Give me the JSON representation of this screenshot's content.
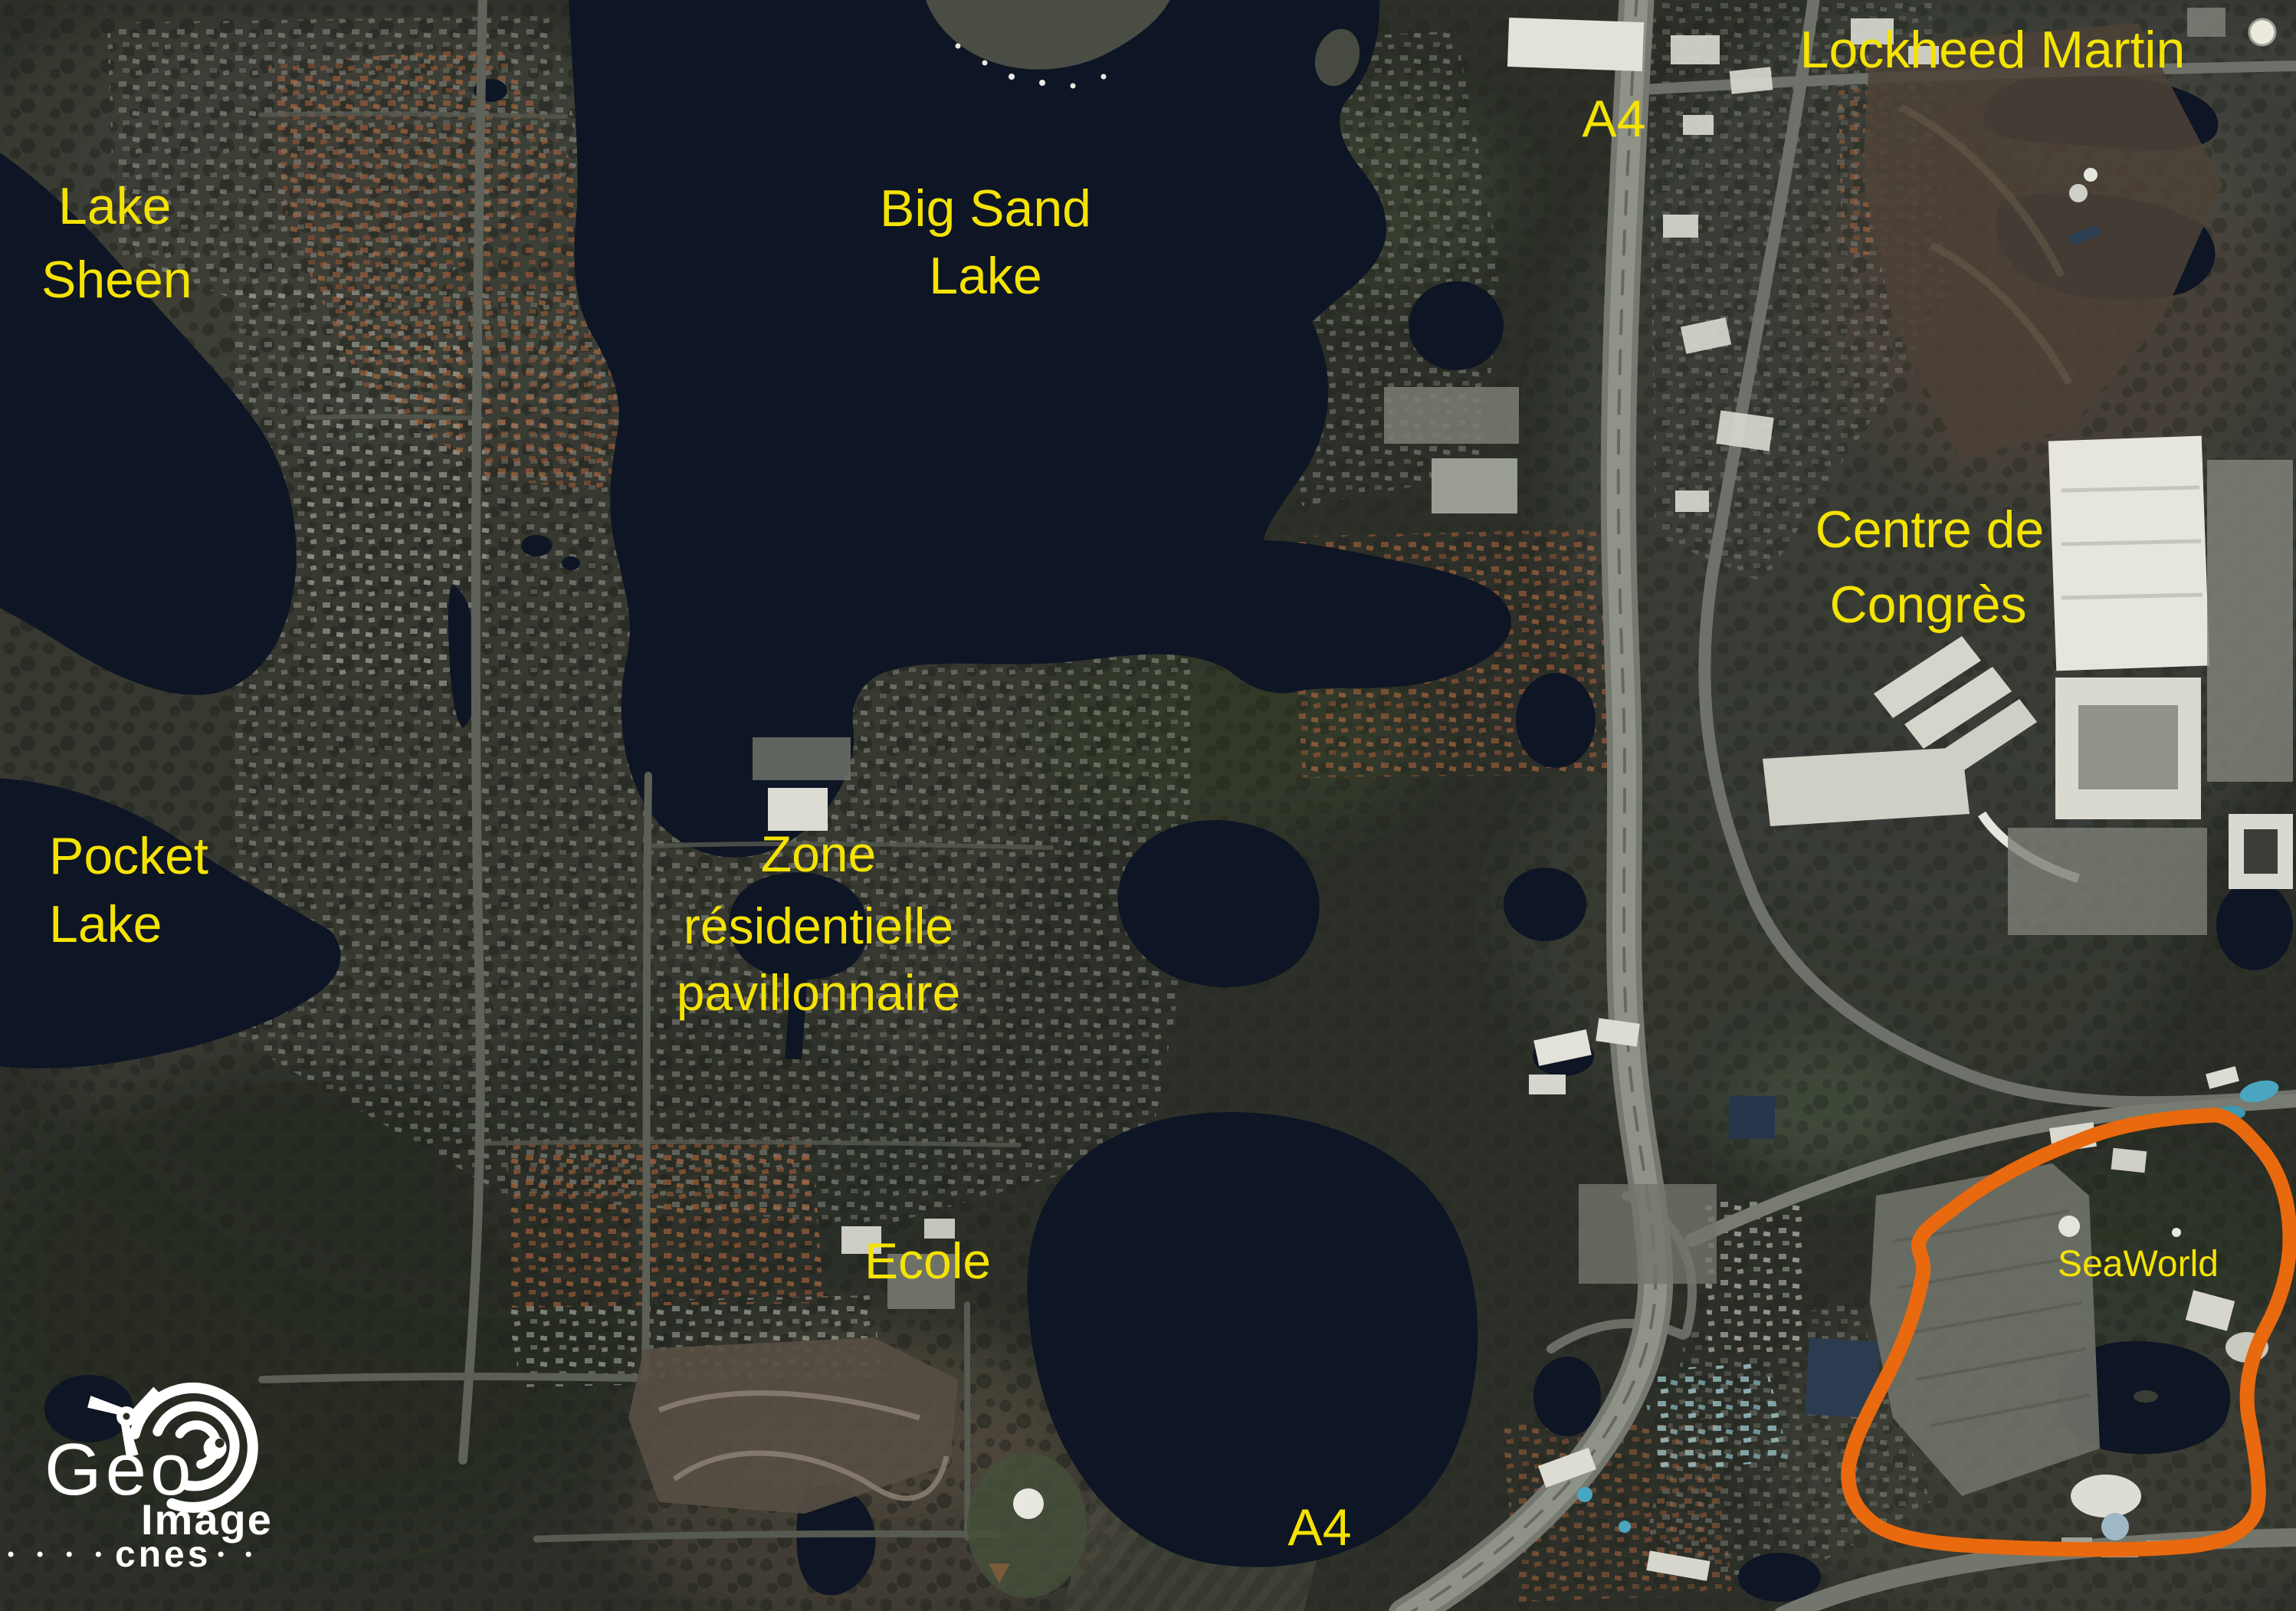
{
  "map": {
    "labels": {
      "lake_sheen_line1": "Lake",
      "lake_sheen_line2": "Sheen",
      "big_sand_line1": "Big Sand",
      "big_sand_line2": "Lake",
      "a4_top": "A4",
      "lockheed_martin": "Lockheed Martin",
      "centre_congres_line1": "Centre de",
      "centre_congres_line2": "Congrès",
      "pocket_lake_line1": "Pocket",
      "pocket_lake_line2": "Lake",
      "zone_line1": "Zone",
      "zone_line2": "résidentielle",
      "zone_line3": "pavillonnaire",
      "ecole": "Ecole",
      "a4_bottom": "A4",
      "seaworld": "SeaWorld"
    },
    "colors": {
      "label_yellow": "#f4e303",
      "seaworld_outline_orange": "#e9690e",
      "water": "#0e1524"
    }
  },
  "logo": {
    "geo": "Geo",
    "image": "Image",
    "cnes": "cnes"
  }
}
